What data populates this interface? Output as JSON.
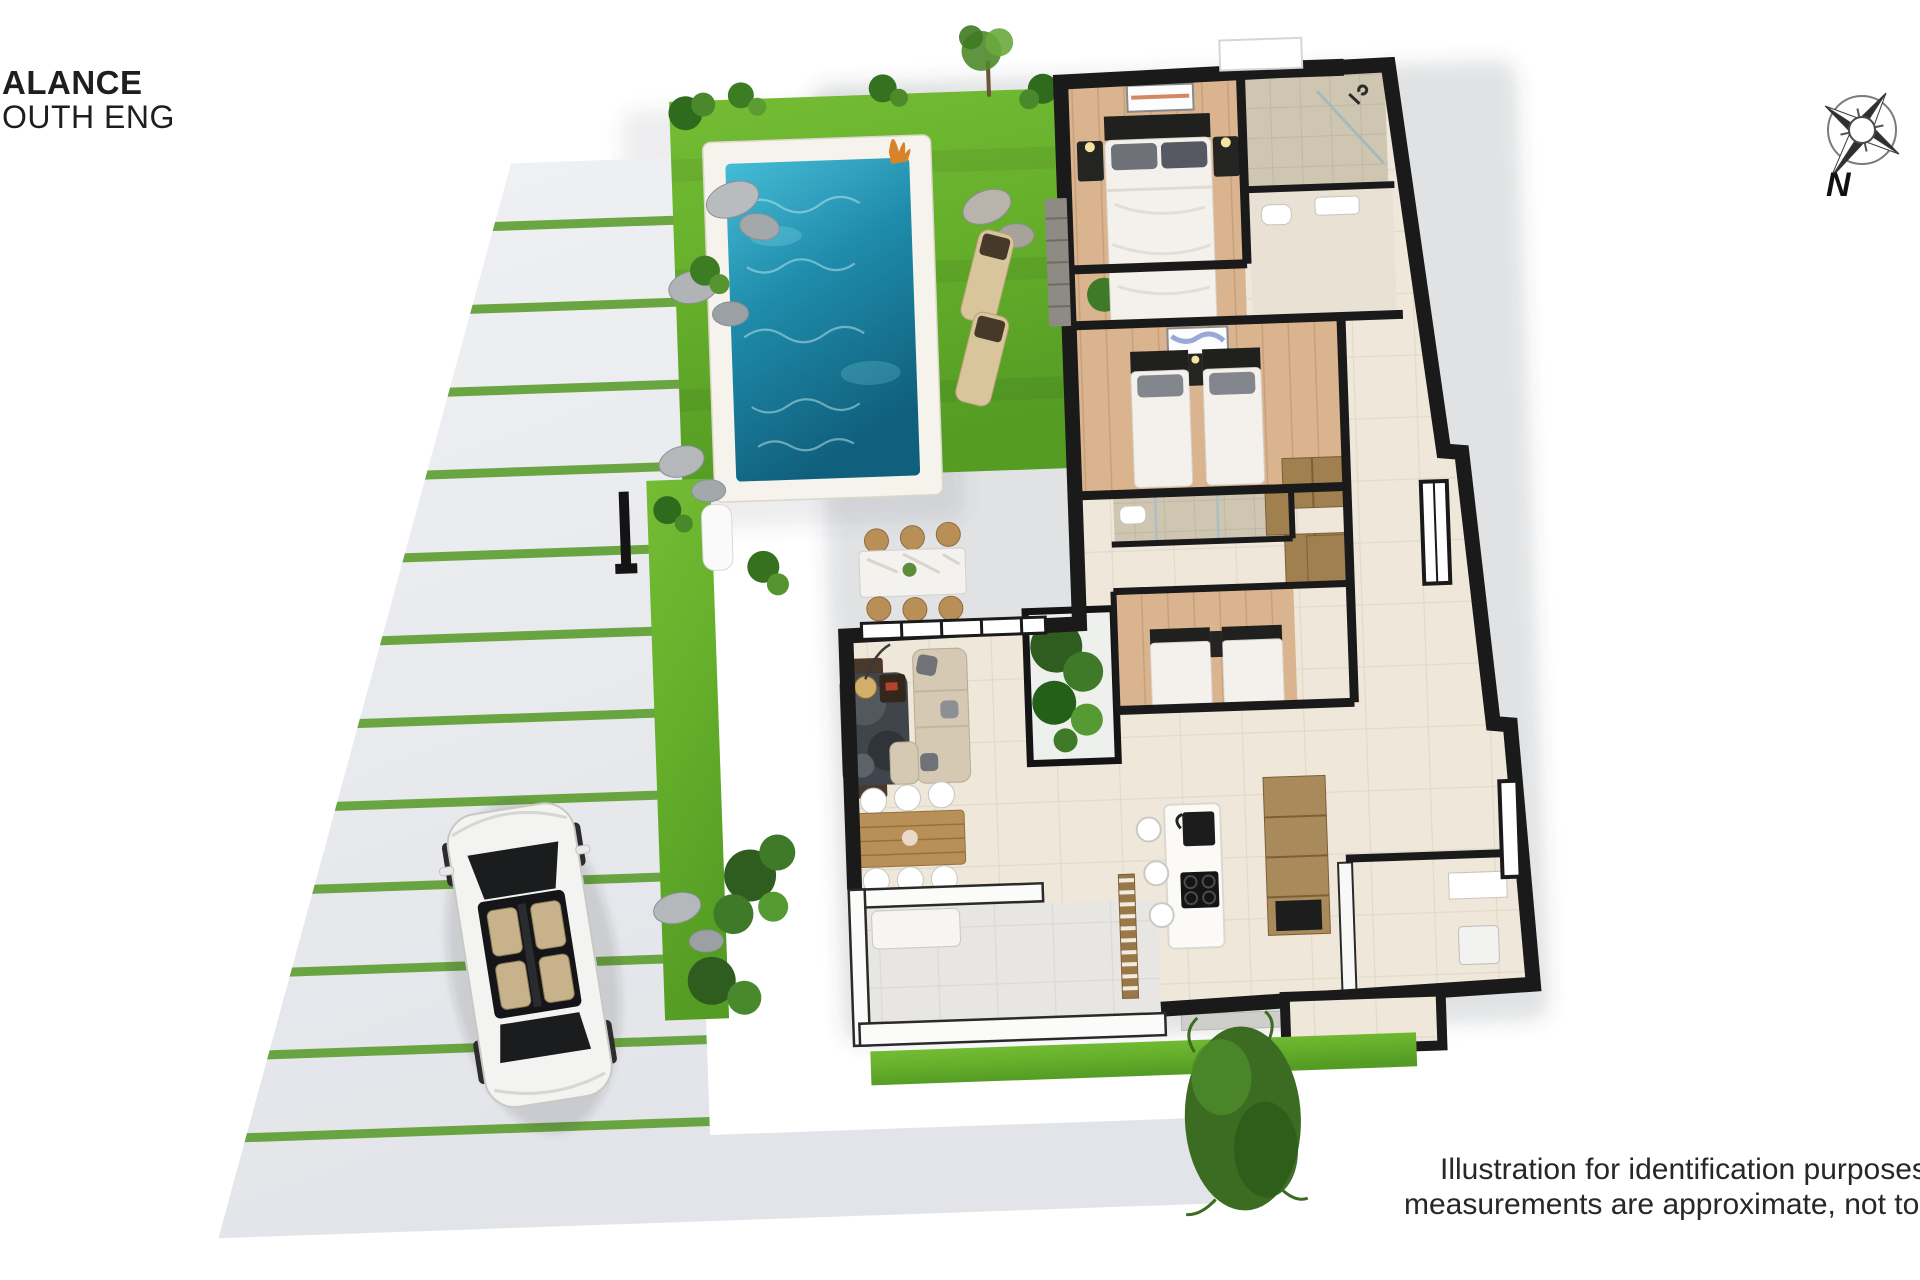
{
  "header": {
    "line1": "ALANCE",
    "line2": "OUTH ENG"
  },
  "compass": {
    "label": "N"
  },
  "footer": {
    "line1": "Illustration for identification purposes onl",
    "line2": "measurements are approximate, not to sca"
  },
  "palette": {
    "wall_black": "#1a1a1a",
    "lawn_green": "#67b22e",
    "stripe_green": "#5f9f33",
    "pool_blue_light": "#4ec6dd",
    "pool_blue_deep": "#0f607e",
    "pavement_gray": "#e9ebee",
    "wood_floor": "#d9b48f",
    "tile_cream": "#efe8da",
    "bath_tile": "#cfc6b2",
    "furniture_wood": "#a0804f",
    "sofa_beige": "#d6c9b4",
    "text_dark": "#272727"
  }
}
